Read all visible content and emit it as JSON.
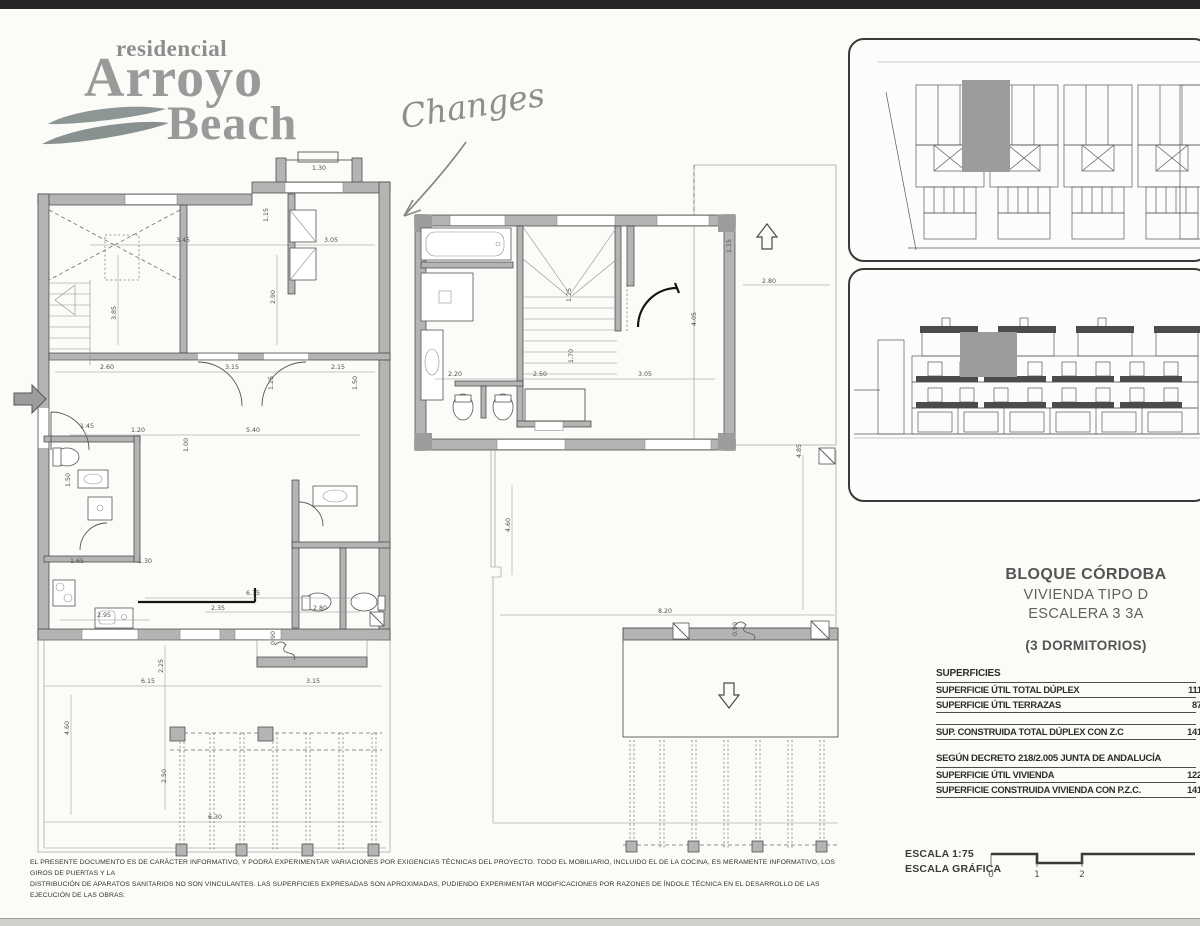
{
  "logo": {
    "line1": "residencial",
    "line2": "Arroyo",
    "line3": "Beach"
  },
  "annotation": {
    "text": "Changes"
  },
  "titleblock": {
    "line1": "BLOQUE CÓRDOBA",
    "line2": "VIVIENDA TIPO D",
    "line3": "ESCALERA 3  3A",
    "line4": "(3 DORMITORIOS)"
  },
  "superficies": {
    "header": "SUPERFICIES",
    "rows": [
      {
        "label": "SUPERFICIE ÚTIL TOTAL DÚPLEX",
        "value": "111,"
      },
      {
        "label": "SUPERFICIE ÚTIL TERRAZAS",
        "value": "87,"
      },
      {
        "label": "SUP. CONSTRUIDA TOTAL DÚPLEX CON Z.C",
        "value": "141,"
      }
    ],
    "decree_header": "SEGÚN DECRETO 218/2.005 JUNTA DE ANDALUCÍA",
    "decree_rows": [
      {
        "label": "SUPERFICIE ÚTIL VIVIENDA",
        "value": "122,"
      },
      {
        "label": "SUPERFICIE CONSTRUIDA VIVIENDA CON P.Z.C.",
        "value": "141,"
      }
    ]
  },
  "disclaimer": {
    "line1": "EL PRESENTE DOCUMENTO ES DE CARÁCTER INFORMATIVO, Y PODRÁ EXPERIMENTAR VARIACIONES POR EXIGENCIAS TÉCNICAS DEL PROYECTO. TODO EL MOBILIARIO, INCLUIDO EL DE LA COCINA, ES MERAMENTE INFORMATIVO, LOS GIROS DE PUERTAS Y LA",
    "line2": "DISTRIBUCIÓN DE APARATOS SANITARIOS NO SON VINCULANTES. LAS SUPERFICIES EXPRESADAS SON APROXIMADAS, PUDIENDO EXPERIMENTAR MODIFICACIONES POR RAZONES DE ÍNDOLE TÉCNICA EN EL DESARROLLO DE LAS EJECUCIÓN DE LAS OBRAS."
  },
  "escala": {
    "label1": "ESCALA 1:75",
    "label2": "ESCALA GRÁFICA",
    "ticks": [
      "0",
      "1",
      "2"
    ]
  },
  "plans": {
    "left": {
      "dims": [
        "1.30",
        "1.15",
        "3.45",
        "3.05",
        "3.85",
        "2.90",
        "2.60",
        "3.15",
        "2.15",
        "1.25",
        "1.50",
        "1.20",
        "5.40",
        "1.45",
        "1.00",
        "1.50",
        "1.65",
        "1.30",
        "2.95",
        "6.15",
        "2.25",
        "2.35",
        "2.80",
        "0.90",
        "6.15",
        "3.15",
        "4.60",
        "2.50",
        "6.30"
      ]
    },
    "middle": {
      "dims": [
        "1.15",
        "2.20",
        "2.50",
        "3.05",
        "1.25",
        "1.70",
        "4.05",
        "2.80",
        "4.85",
        "8.20",
        "4.60",
        "0.90"
      ]
    }
  },
  "colors": {
    "wall_gray": "#b4b4b4",
    "highlight_gray": "#9c9c9c",
    "scan_strip": "#272727"
  }
}
